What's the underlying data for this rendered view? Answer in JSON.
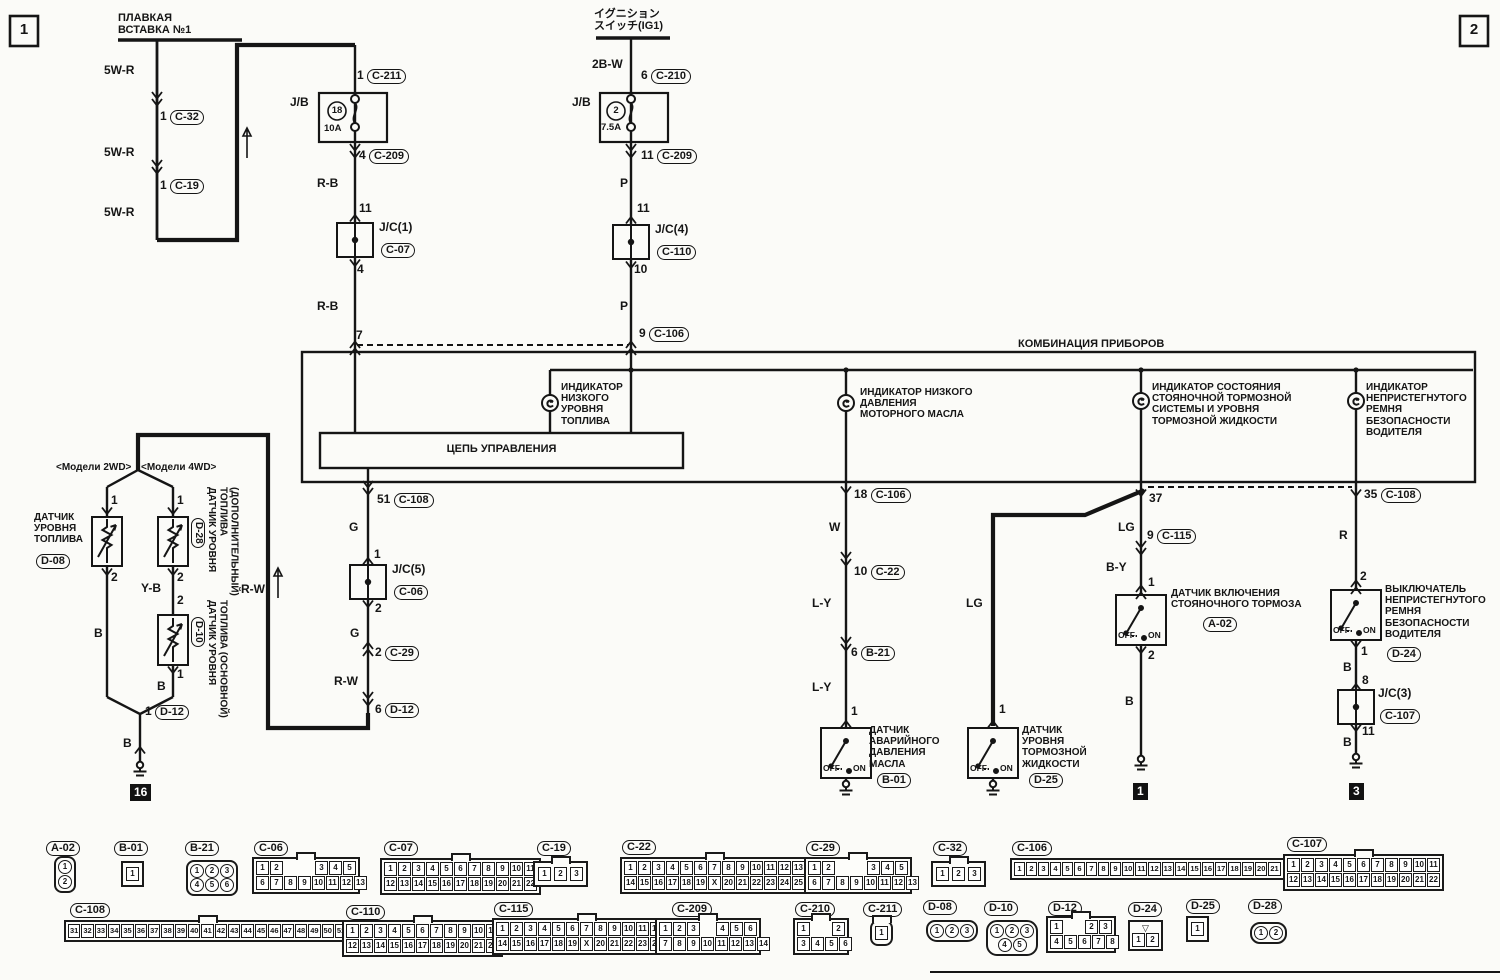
{
  "page": {
    "corner_left": "1",
    "corner_right": "2"
  },
  "switch_labels": {
    "off": "OFF",
    "on": "ON"
  },
  "fusible": {
    "title": "ПЛАВКАЯ\nВСТАВКА №1",
    "wire1": "5W-R",
    "wire2": "5W-R",
    "wire3": "5W-R",
    "pin_c32": "1",
    "conn_c32": "C-32",
    "pin_c19": "1",
    "conn_c19": "C-19"
  },
  "jb1": {
    "label": "J/B",
    "fuse_no": "18",
    "amp": "10A",
    "pin_top": "1",
    "conn_top": "C-211",
    "pin_bot": "4",
    "conn_bot": "C-209",
    "wire_out": "R-B"
  },
  "jc1": {
    "pin_in": "11",
    "name": "J/C(1)",
    "conn": "C-07",
    "pin_out": "4",
    "wire_out": "R-B",
    "pin_meter": "7"
  },
  "ignition": {
    "title": "イグニション\nスイッチ(IG1)",
    "wire": "2B-W",
    "pin": "6",
    "conn": "C-210"
  },
  "jb2": {
    "label": "J/B",
    "fuse_no": "2",
    "amp": "7.5A",
    "pin_bot": "11",
    "conn_bot": "C-209",
    "wire_out": "P"
  },
  "jc4": {
    "pin_in": "11",
    "name": "J/C(4)",
    "conn": "C-110",
    "pin_out": "10",
    "wire_out": "P",
    "pin_meter": "9",
    "conn_meter": "C-106"
  },
  "meter": {
    "title": "КОМБИНАЦИЯ ПРИБОРОВ",
    "control_box": "ЦЕПЬ УПРАВЛЕНИЯ",
    "ind_fuel": "ИНДИКАТОР\nНИЗКОГО\nУРОВНЯ\nТОПЛИВА",
    "ind_oil": "ИНДИКАТОР НИЗКОГО\nДАВЛЕНИЯ\nМОТОРНОГО МАСЛА",
    "ind_brake": "ИНДИКАТОР СОСТОЯНИЯ\nСТОЯНОЧНОЙ ТОРМОЗНОЙ\nСИСТЕМЫ И УРОВНЯ\nТОРМОЗНОЙ ЖИДКОСТИ",
    "ind_belt": "ИНДИКАТОР\nНЕПРИСТЕГНУТОГО\nРЕМНЯ\nБЕЗОПАСНОСТИ\nВОДИТЕЛЯ"
  },
  "fuel_out": {
    "pin51": "51",
    "conn108": "C-108",
    "wire_g1": "G",
    "pin_jc_in": "1",
    "jc5": "J/C(5)",
    "conn06": "C-06",
    "pin_jc_out": "2",
    "wire_g2": "G",
    "pin_c29": "2",
    "conn29": "C-29",
    "wire_rw": "R-W",
    "pin_d12": "6",
    "conn_d12": "D-12"
  },
  "senders": {
    "model_2wd": "<Модели 2WD>",
    "model_4wd": "<Модели 4WD>",
    "d08_label": "ДАТЧИК\nУРОВНЯ\nТОПЛИВА",
    "d08_conn": "D-08",
    "d08_pin1": "1",
    "d08_pin2": "2",
    "d08_wire": "B",
    "d28_conn": "D-28",
    "d28_label": "ДАТЧИК УРОВНЯ\nТОПЛИВА\n(ДОПОЛНИТЕЛЬНЫЙ)",
    "d28_pin1": "1",
    "d28_pin2": "2",
    "wire_yb": "Y-B",
    "d10_pin2": "2",
    "d10_conn": "D-10",
    "d10_label": "ДАТЧИК УРОВНЯ\nТОПЛИВА (ОСНОВНОЙ)",
    "d10_pin1": "1",
    "d10_wire": "B",
    "out_pin": "1",
    "out_conn": "D-12",
    "out_wire": "B",
    "ground_tag": "16",
    "trunk_wire": "R-W"
  },
  "oil": {
    "pin18": "18",
    "conn106": "C-106",
    "wire_w": "W",
    "pin10": "10",
    "conn22": "C-22",
    "wire_ly1": "L-Y",
    "pin6": "6",
    "conn_b21": "B-21",
    "wire_ly2": "L-Y",
    "pin1": "1",
    "label": "ДАТЧИК\nАВАРИЙНОГО\nДАВЛЕНИЯ\nМАСЛА",
    "conn": "B-01"
  },
  "brake_fluid": {
    "wire_lg": "LG",
    "pin1": "1",
    "label": "ДАТЧИК\nУРОВНЯ\nТОРМОЗНОЙ\nЖИДКОСТИ",
    "conn": "D-25"
  },
  "parking": {
    "pin37": "37",
    "wire_lg": "LG",
    "pin9": "9",
    "conn115": "C-115",
    "wire_by": "B-Y",
    "pin1": "1",
    "label": "ДАТЧИК ВКЛЮЧЕНИЯ\nСТОЯНОЧНОГО ТОРМОЗА",
    "conn": "A-02",
    "pin2": "2",
    "wire_b": "B",
    "ground_tag": "1"
  },
  "belt": {
    "pin35": "35",
    "conn108": "C-108",
    "wire_r": "R",
    "pin2": "2",
    "label": "ВЫКЛЮЧАТЕЛЬ\nНЕПРИСТЕГНУТОГО\nРЕМНЯ\nБЕЗОПАСНОСТИ\nВОДИТЕЛЯ",
    "conn": "D-24",
    "pin1": "1",
    "wire_b1": "B",
    "pin8": "8",
    "jc3": "J/C(3)",
    "conn107": "C-107",
    "pin11": "11",
    "wire_b2": "B",
    "ground_tag": "3"
  },
  "connectors": {
    "a02": {
      "name": "A-02",
      "pins": [
        "1",
        "2"
      ]
    },
    "b01": {
      "name": "B-01",
      "pins": [
        "1"
      ]
    },
    "b21": {
      "name": "B-21",
      "row1": [
        "1",
        "2",
        "3"
      ],
      "row2": [
        "4",
        "5",
        "6"
      ]
    },
    "c06": {
      "name": "C-06",
      "tl": [
        "1",
        "2"
      ],
      "tr": [
        "3",
        "4",
        "5"
      ],
      "bottom": [
        "6",
        "7",
        "8",
        "9",
        "10",
        "11",
        "12",
        "13"
      ]
    },
    "c07": {
      "name": "C-07",
      "row1": [
        "1",
        "2",
        "3",
        "4",
        "5",
        "6",
        "7",
        "8",
        "9",
        "10",
        "11"
      ],
      "row2": [
        "12",
        "13",
        "14",
        "15",
        "16",
        "17",
        "18",
        "19",
        "20",
        "21",
        "22"
      ]
    },
    "c19": {
      "name": "C-19",
      "pins": [
        "1",
        "2",
        "3"
      ]
    },
    "c22": {
      "name": "C-22",
      "row1": [
        "1",
        "2",
        "3",
        "4",
        "5",
        "6",
        "7",
        "8",
        "9",
        "10",
        "11",
        "12",
        "13"
      ],
      "row2": [
        "14",
        "15",
        "16",
        "17",
        "18",
        "19",
        "X",
        "20",
        "21",
        "22",
        "23",
        "24",
        "25"
      ]
    },
    "c29": {
      "name": "C-29",
      "tl": [
        "1",
        "2"
      ],
      "tr": [
        "3",
        "4",
        "5"
      ],
      "bottom": [
        "6",
        "7",
        "8",
        "9",
        "10",
        "11",
        "12",
        "13"
      ]
    },
    "c32": {
      "name": "C-32",
      "pins": [
        "1",
        "2",
        "3"
      ]
    },
    "c106": {
      "name": "C-106",
      "pins": [
        "1",
        "2",
        "3",
        "4",
        "5",
        "6",
        "7",
        "8",
        "9",
        "10",
        "11",
        "12",
        "13",
        "14",
        "15",
        "16",
        "17",
        "18",
        "19",
        "20",
        "21"
      ]
    },
    "c107": {
      "name": "C-107",
      "row1": [
        "1",
        "2",
        "3",
        "4",
        "5",
        "6",
        "7",
        "8",
        "9",
        "10",
        "11"
      ],
      "row2": [
        "12",
        "13",
        "14",
        "15",
        "16",
        "17",
        "18",
        "19",
        "20",
        "21",
        "22"
      ]
    },
    "c108": {
      "name": "C-108",
      "pins": [
        "31",
        "32",
        "33",
        "34",
        "35",
        "36",
        "37",
        "38",
        "39",
        "40",
        "41",
        "42",
        "43",
        "44",
        "45",
        "46",
        "47",
        "48",
        "49",
        "50",
        "51"
      ]
    },
    "c110": {
      "name": "C-110",
      "row1": [
        "1",
        "2",
        "3",
        "4",
        "5",
        "6",
        "7",
        "8",
        "9",
        "10",
        "11"
      ],
      "row2": [
        "12",
        "13",
        "14",
        "15",
        "16",
        "17",
        "18",
        "19",
        "20",
        "21",
        "22"
      ]
    },
    "c115": {
      "name": "C-115",
      "row1": [
        "1",
        "2",
        "3",
        "4",
        "5",
        "6",
        "7",
        "8",
        "9",
        "10",
        "11",
        "12",
        "13"
      ],
      "row2": [
        "14",
        "15",
        "16",
        "17",
        "18",
        "19",
        "X",
        "20",
        "21",
        "22",
        "23",
        "24",
        "25"
      ]
    },
    "c209": {
      "name": "C-209",
      "tl": [
        "1",
        "2",
        "3"
      ],
      "tr": [
        "4",
        "5",
        "6"
      ],
      "bottom": [
        "7",
        "8",
        "9",
        "10",
        "11",
        "12",
        "13",
        "14"
      ]
    },
    "c210": {
      "name": "C-210",
      "tl": [
        "1"
      ],
      "tr": [
        "2"
      ],
      "bottom": [
        "3",
        "4",
        "5",
        "6"
      ]
    },
    "c211": {
      "name": "C-211",
      "pins": [
        "1"
      ]
    },
    "d08": {
      "name": "D-08",
      "pins": [
        "1",
        "2",
        "3"
      ]
    },
    "d10": {
      "name": "D-10",
      "row1": [
        "1",
        "2",
        "3"
      ],
      "row2": [
        "4",
        "5"
      ]
    },
    "d12": {
      "name": "D-12",
      "tl": [
        "1"
      ],
      "tr": [
        "2",
        "3"
      ],
      "bottom": [
        "4",
        "5",
        "6",
        "7",
        "8"
      ]
    },
    "d24": {
      "name": "D-24",
      "notch_icon": "▽",
      "pins": [
        "1",
        "2"
      ]
    },
    "d25": {
      "name": "D-25",
      "pins": [
        "1"
      ]
    },
    "d28": {
      "name": "D-28",
      "pins": [
        "1",
        "2"
      ]
    }
  }
}
